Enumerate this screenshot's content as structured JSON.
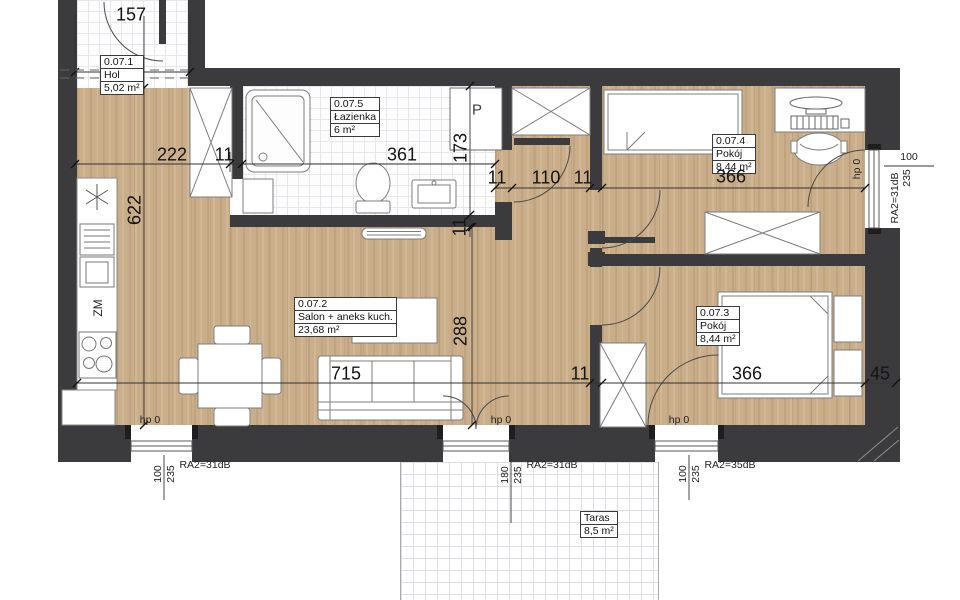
{
  "colors": {
    "wall": "#3b3b3d",
    "wood": "#c9ae89",
    "dim_line": "#333333"
  },
  "rooms": {
    "hol": {
      "id": "0.07.1",
      "name": "Hol",
      "area": "5,02 m²"
    },
    "salon": {
      "id": "0.07.2",
      "name": "Salon + aneks kuch.",
      "area": "23,68 m²"
    },
    "room3": {
      "id": "0.07.3",
      "name": "Pokój",
      "area": "8,44 m²"
    },
    "room4": {
      "id": "0.07.4",
      "name": "Pokój",
      "area": "8,44 m²"
    },
    "bath": {
      "id": "0.07.5",
      "name": "Łazienka",
      "area": "6 m²"
    },
    "terrace": {
      "name": "Taras",
      "area": "8,5 m²"
    }
  },
  "labels": {
    "shaft": "P",
    "dishwasher": "ZM"
  },
  "dims": {
    "hall_w": "157",
    "top_222": "222",
    "top_11": "11",
    "bath_w": "361",
    "bath_h": "173",
    "bath_wall_11": "11",
    "mid_11a": "11",
    "corridor_110": "110",
    "mid_11b": "11",
    "room4_w": "366",
    "kitchen_h": "622",
    "salon_h": "288",
    "salon_w": "715",
    "bot_11": "11",
    "room3_w": "366",
    "gap_45": "45"
  },
  "windows": {
    "south_left": {
      "hp": "hp 0",
      "w": "100",
      "h": "235",
      "ra": "RA2=31dB"
    },
    "south_mid": {
      "hp": "hp 0",
      "w": "180",
      "h": "235",
      "ra": "RA2=31dB"
    },
    "south_right": {
      "hp": "hp 0",
      "w": "100",
      "h": "235",
      "ra": "RA2=35dB"
    },
    "east": {
      "hp": "hp 0",
      "w": "100",
      "h": "235",
      "ra": "RA2=31dB"
    }
  }
}
